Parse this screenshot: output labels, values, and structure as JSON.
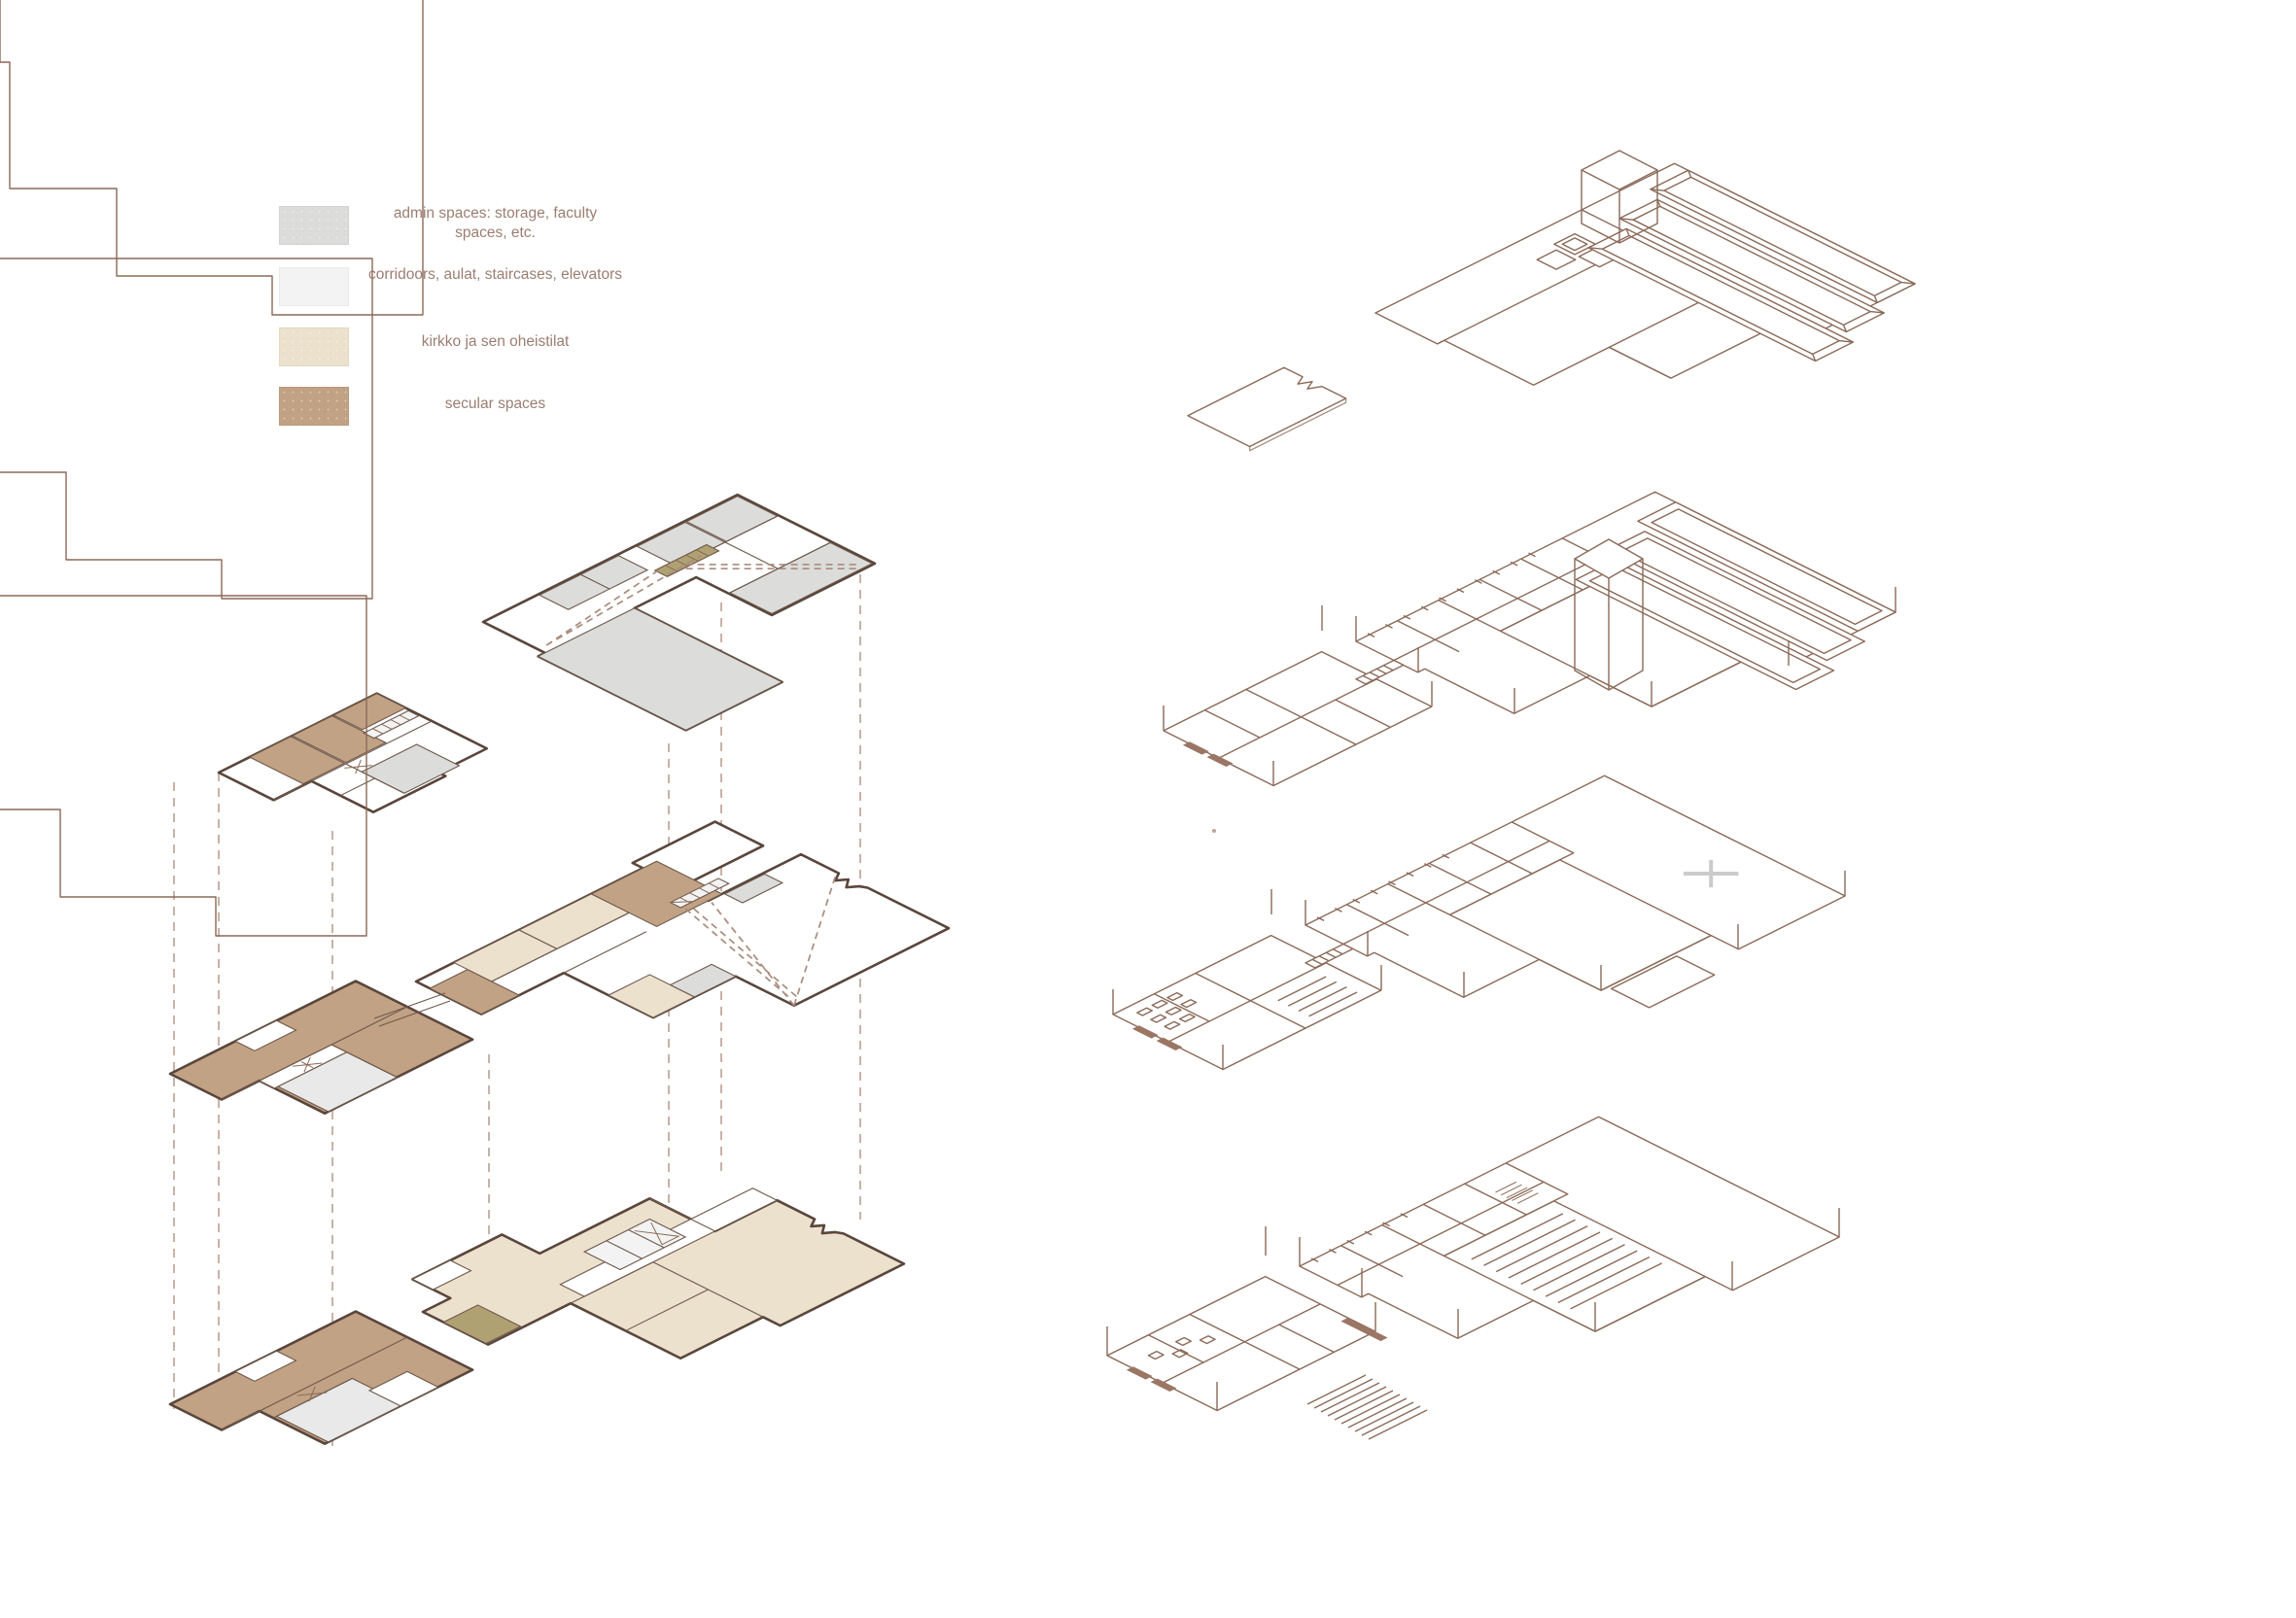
{
  "page": {
    "background": "#ffffff"
  },
  "legend": {
    "items": [
      {
        "label": "admin spaces: storage, faculty spaces, etc.",
        "color": "#dcdcdb"
      },
      {
        "label": "corridoors, aulat, staircases, elevators",
        "color": "#f2f3f2"
      },
      {
        "label": "kirkko ja sen oheistilat",
        "color": "#ece1cd"
      },
      {
        "label": "secular spaces",
        "color": "#c2a284"
      }
    ]
  },
  "palette": {
    "plan_outline": "#5a463c",
    "wireframe_line": "#8a6a59",
    "projection_dash": "#c9b2a6",
    "legend_text": "#9b7e71",
    "stair_olive": "#b0a172",
    "paper": "#ffffff"
  }
}
